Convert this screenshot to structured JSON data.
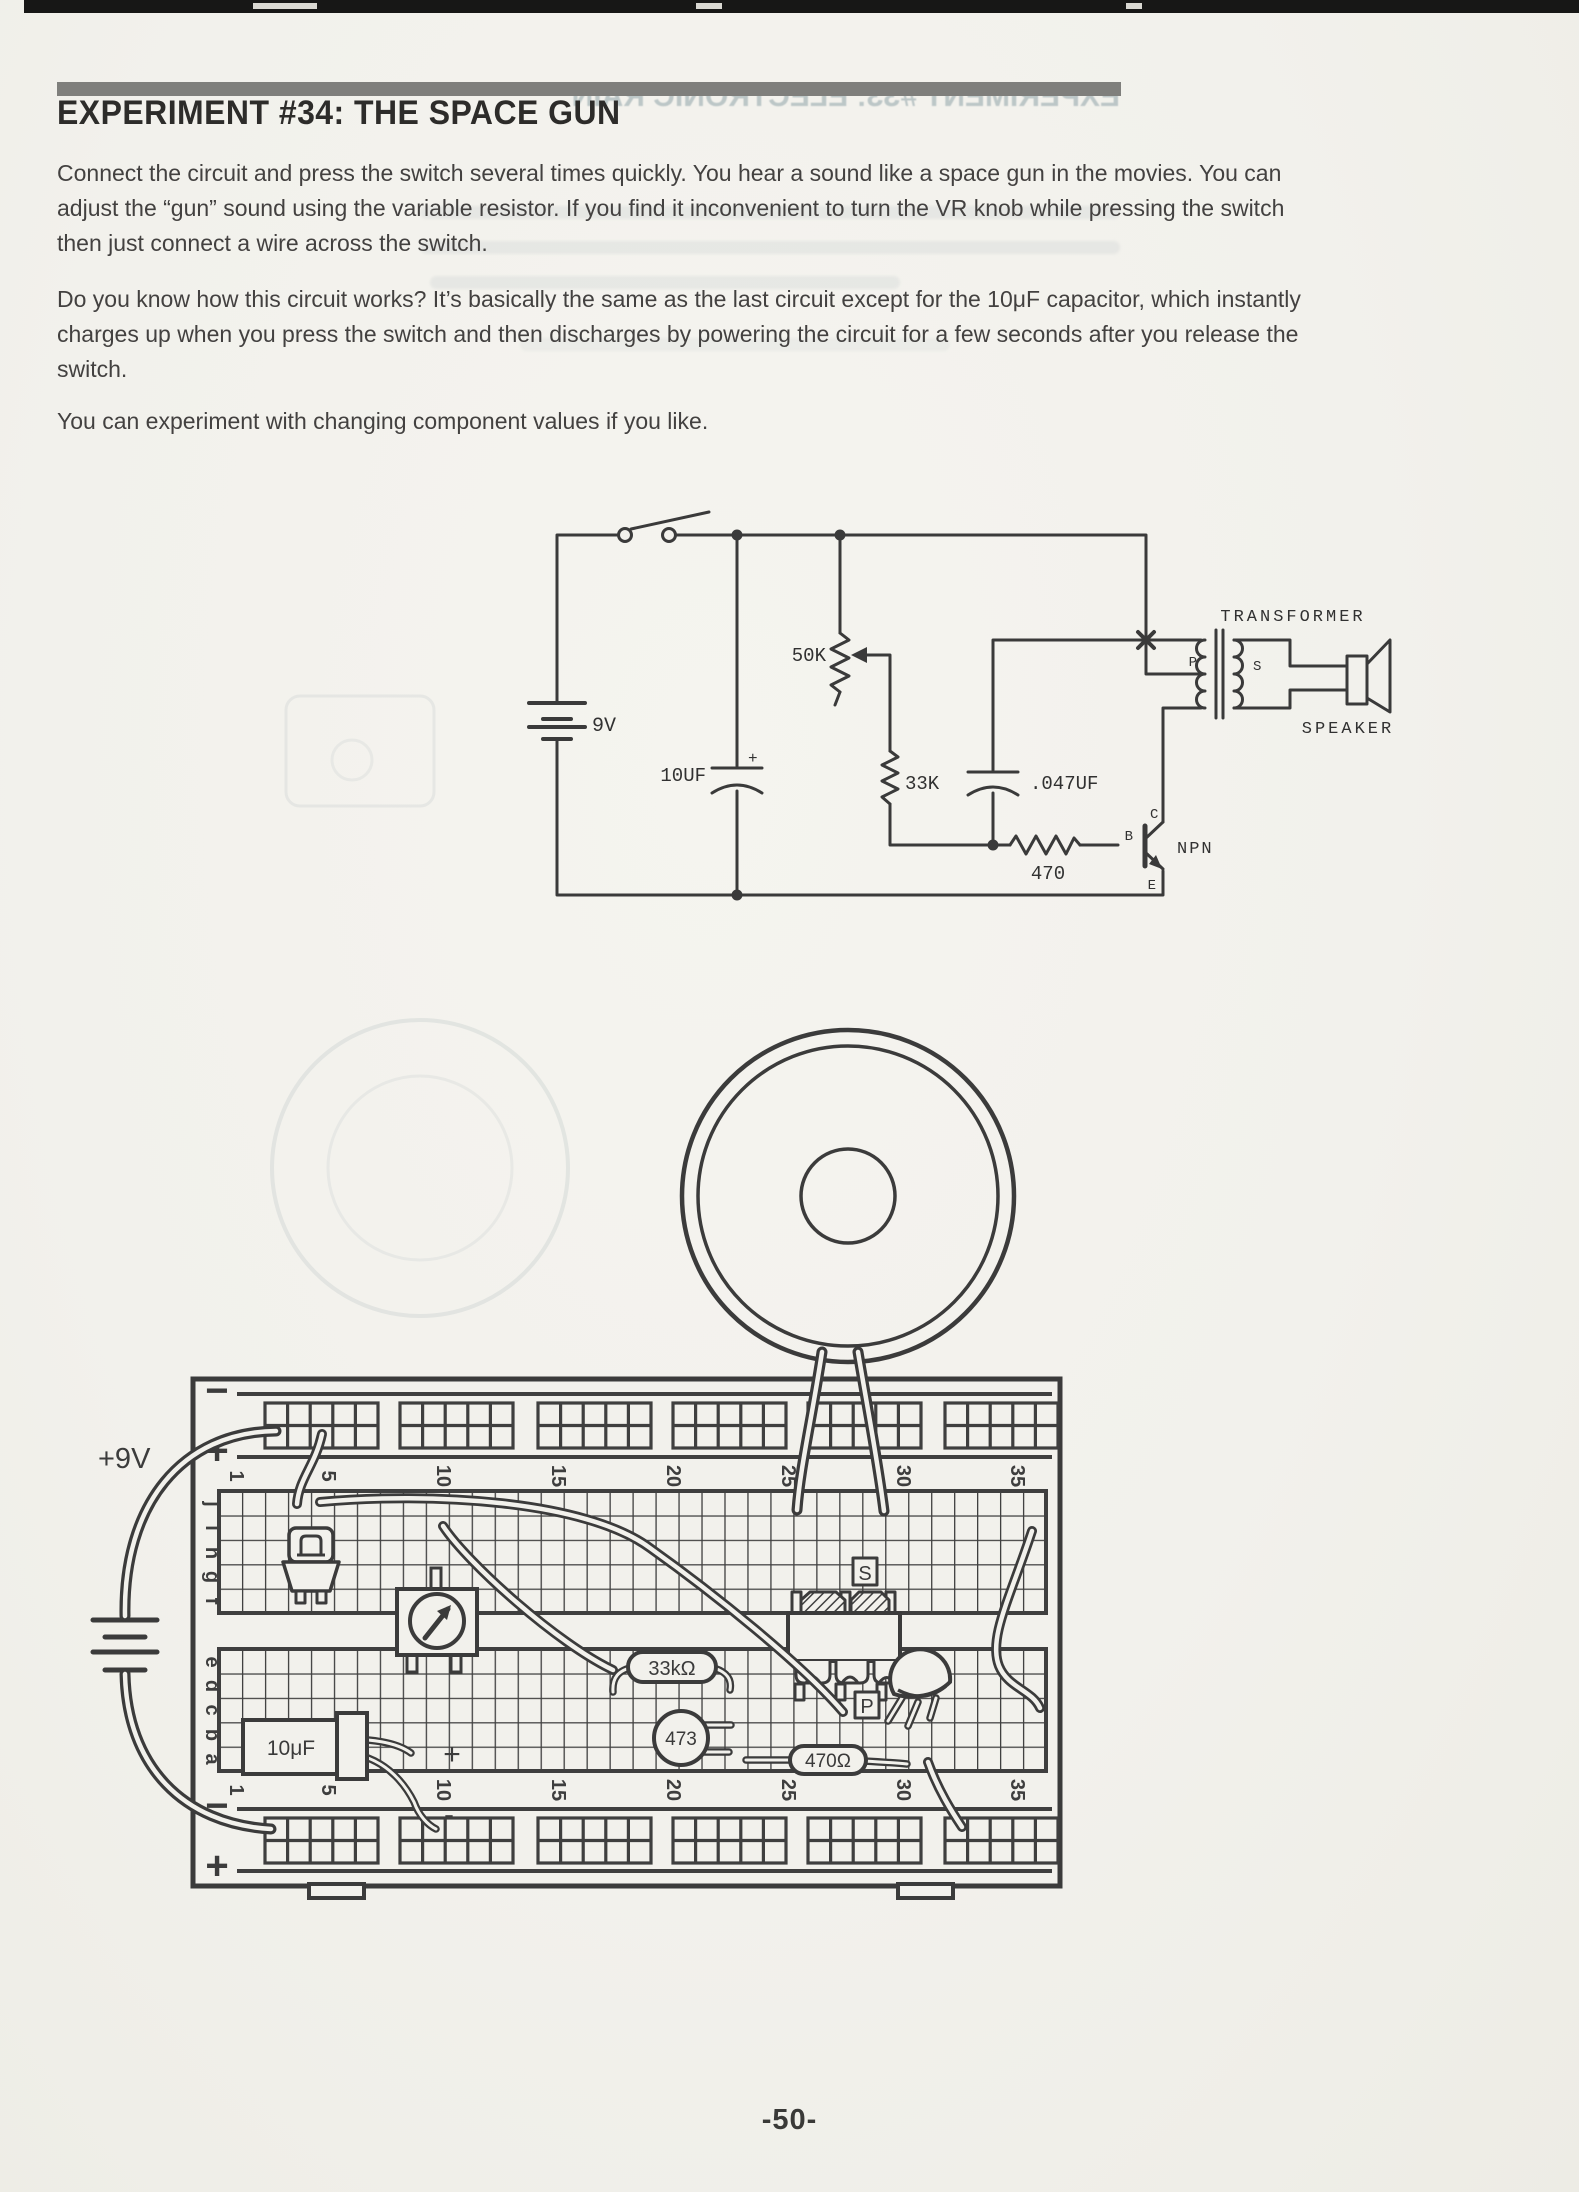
{
  "page": {
    "title": "EXPERIMENT #34:  THE SPACE GUN",
    "ghost_title": "EXPERIMENT #33:  ELECTRONIC RAIN",
    "page_number": "-50-",
    "paragraphs": [
      {
        "lines": [
          "Connect the circuit and press the switch several times quickly.  You hear a sound like a space gun in the movies.  You can",
          "adjust the “gun” sound using the variable resistor.  If you find it inconvenient to turn the VR knob while pressing the switch",
          "then just connect a wire across the switch."
        ]
      },
      {
        "lines": [
          "Do you know how this circuit works?  It’s basically the same as the last circuit except for the 10μF capacitor, which instantly",
          "charges up when you press the switch and then discharges by powering the circuit for a few seconds after you release the",
          "switch."
        ]
      },
      {
        "lines": [
          "You can experiment with changing component values if you like."
        ]
      }
    ]
  },
  "schematic": {
    "battery": "9V",
    "cap_10uf": "10UF",
    "cap_plus": "+",
    "vr_50k": "50K",
    "res_33k": "33K",
    "cap_047": ".047UF",
    "res_470": "470",
    "transistor_type": "NPN",
    "pin_b": "B",
    "pin_c": "C",
    "pin_e": "E",
    "transformer": "TRANSFORMER",
    "primary": "P",
    "secondary": "S",
    "speaker": "SPEAKER"
  },
  "breadboard": {
    "supply": "+9V",
    "rail_minus": "−",
    "rail_plus": "+",
    "rows_top": [
      "j",
      "i",
      "h",
      "g",
      "f"
    ],
    "rows_bottom": [
      "e",
      "d",
      "c",
      "b",
      "a"
    ],
    "cols": [
      "1",
      "5",
      "10",
      "15",
      "20",
      "25",
      "30",
      "35"
    ],
    "cap_10uf": "10μF",
    "res_33k": "33kΩ",
    "cap_473": "473",
    "res_470": "470Ω",
    "xfmr_s": "S",
    "xfmr_p": "P",
    "plus_mark": "+",
    "minus_mark": "-"
  }
}
